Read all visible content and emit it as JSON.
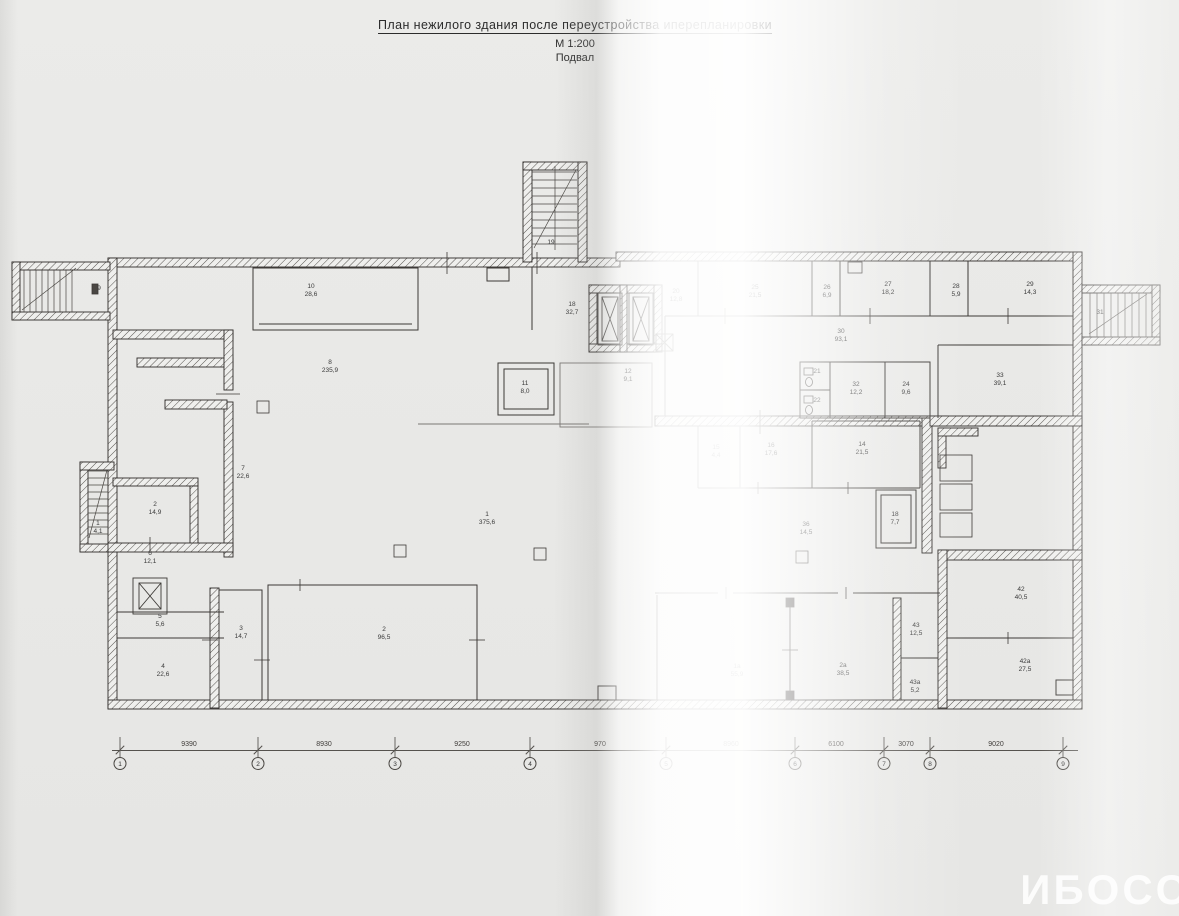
{
  "page": {
    "paper_color": "#e9e9e7",
    "ink_color": "#2f2f2f"
  },
  "title_block": {
    "title": "План нежилого здания после переустройства иперепланировки",
    "scale": "М 1:200",
    "floor": "Подвал"
  },
  "watermark": "ИБОСС",
  "plan": {
    "rooms": [
      {
        "num": "9",
        "area": "",
        "x": 99,
        "y": 289
      },
      {
        "num": "10",
        "area": "28,6",
        "x": 311,
        "y": 291
      },
      {
        "num": "8",
        "area": "235,9",
        "x": 330,
        "y": 367
      },
      {
        "num": "7",
        "area": "22,6",
        "x": 243,
        "y": 473
      },
      {
        "num": "2",
        "area": "14,9",
        "x": 155,
        "y": 509
      },
      {
        "num": "1",
        "area": "4,1",
        "x": 98,
        "y": 528
      },
      {
        "num": "6",
        "area": "12,1",
        "x": 150,
        "y": 558
      },
      {
        "num": "5",
        "area": "5,6",
        "x": 160,
        "y": 621
      },
      {
        "num": "3",
        "area": "14,7",
        "x": 241,
        "y": 633
      },
      {
        "num": "4",
        "area": "22,6",
        "x": 163,
        "y": 671
      },
      {
        "num": "2",
        "area": "96,5",
        "x": 384,
        "y": 634
      },
      {
        "num": "1",
        "area": "375,6",
        "x": 487,
        "y": 519
      },
      {
        "num": "11",
        "area": "8,0",
        "x": 525,
        "y": 388
      },
      {
        "num": "18",
        "area": "32,7",
        "x": 572,
        "y": 309
      },
      {
        "num": "19",
        "area": "",
        "x": 551,
        "y": 243
      },
      {
        "num": "12",
        "area": "9,1",
        "x": 628,
        "y": 376
      },
      {
        "num": "20",
        "area": "12,8",
        "x": 676,
        "y": 296
      },
      {
        "num": "25",
        "area": "21,5",
        "x": 755,
        "y": 292
      },
      {
        "num": "26",
        "area": "6,9",
        "x": 827,
        "y": 292
      },
      {
        "num": "27",
        "area": "18,2",
        "x": 888,
        "y": 289
      },
      {
        "num": "28",
        "area": "5,9",
        "x": 956,
        "y": 291
      },
      {
        "num": "29",
        "area": "14,3",
        "x": 1030,
        "y": 289
      },
      {
        "num": "30",
        "area": "93,1",
        "x": 841,
        "y": 336
      },
      {
        "num": "31",
        "area": "",
        "x": 1100,
        "y": 313
      },
      {
        "num": "33",
        "area": "39,1",
        "x": 1000,
        "y": 380
      },
      {
        "num": "21",
        "area": "",
        "x": 817,
        "y": 372
      },
      {
        "num": "22",
        "area": "",
        "x": 817,
        "y": 401
      },
      {
        "num": "32",
        "area": "12,2",
        "x": 856,
        "y": 389
      },
      {
        "num": "24",
        "area": "9,6",
        "x": 906,
        "y": 389
      },
      {
        "num": "15",
        "area": "4,4",
        "x": 716,
        "y": 452
      },
      {
        "num": "16",
        "area": "17,6",
        "x": 771,
        "y": 450
      },
      {
        "num": "14",
        "area": "21,5",
        "x": 862,
        "y": 449
      },
      {
        "num": "18",
        "area": "7,7",
        "x": 895,
        "y": 519
      },
      {
        "num": "36",
        "area": "14,5",
        "x": 806,
        "y": 529
      },
      {
        "num": "1а",
        "area": "55,9",
        "x": 737,
        "y": 671
      },
      {
        "num": "2а",
        "area": "38,5",
        "x": 843,
        "y": 670
      },
      {
        "num": "43",
        "area": "12,5",
        "x": 916,
        "y": 630
      },
      {
        "num": "43а",
        "area": "5,2",
        "x": 915,
        "y": 687
      },
      {
        "num": "42",
        "area": "40,5",
        "x": 1021,
        "y": 594
      },
      {
        "num": "42а",
        "area": "27,5",
        "x": 1025,
        "y": 666
      }
    ],
    "axes": {
      "line_y": 750,
      "bubbles": [
        {
          "label": "1",
          "x": 120
        },
        {
          "label": "2",
          "x": 258
        },
        {
          "label": "3",
          "x": 395
        },
        {
          "label": "4",
          "x": 530
        },
        {
          "label": "5",
          "x": 666
        },
        {
          "label": "6",
          "x": 795
        },
        {
          "label": "7",
          "x": 884
        },
        {
          "label": "8",
          "x": 930
        },
        {
          "label": "9",
          "x": 1063
        }
      ],
      "dims": [
        {
          "value": "9390",
          "x": 189
        },
        {
          "value": "8930",
          "x": 324
        },
        {
          "value": "9250",
          "x": 462
        },
        {
          "value": "970",
          "x": 600
        },
        {
          "value": "8960",
          "x": 731
        },
        {
          "value": "6100",
          "x": 836
        },
        {
          "value": "3070",
          "x": 906
        },
        {
          "value": "9020",
          "x": 996
        }
      ]
    }
  }
}
